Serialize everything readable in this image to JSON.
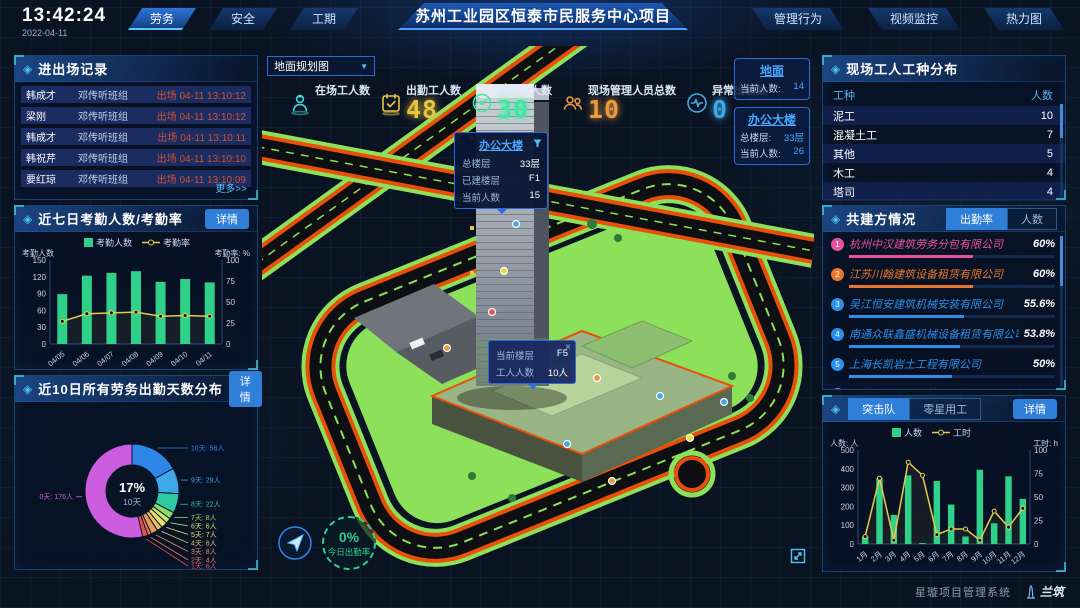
{
  "header": {
    "time": "13:42:24",
    "date": "2022-04-11",
    "nav_left": [
      {
        "label": "劳务",
        "active": true
      },
      {
        "label": "安全",
        "active": false
      },
      {
        "label": "工期",
        "active": false
      }
    ],
    "title": "苏州工业园区恒泰市民服务中心项目",
    "nav_right": [
      {
        "label": "管理行为"
      },
      {
        "label": "视频监控"
      },
      {
        "label": "热力图"
      }
    ]
  },
  "entry_exit": {
    "title": "进出场记录",
    "more_label": "更多>>",
    "rows": [
      {
        "name": "韩成才",
        "team": "邓传听班组",
        "event": "出场 04-11 13:10:12"
      },
      {
        "name": "梁刚",
        "team": "邓传听班组",
        "event": "出场 04-11 13:10:12"
      },
      {
        "name": "韩成才",
        "team": "邓传听班组",
        "event": "出场 04-11 13:10:11"
      },
      {
        "name": "韩祝芹",
        "team": "邓传听班组",
        "event": "出场 04-11 13:10:10"
      },
      {
        "name": "要红琼",
        "team": "邓传听班组",
        "event": "出场 04-11 13:10:09"
      }
    ]
  },
  "attendance_panel": {
    "title": "近七日考勤人数/考勤率",
    "detail_label": "详情",
    "chart": {
      "type": "bar+line",
      "legend": [
        "考勤人数",
        "考勤率"
      ],
      "y_left_label": "考勤人数",
      "y_right_label": "考勤率: %",
      "categories": [
        "04/05",
        "04/06",
        "04/07",
        "04/08",
        "04/09",
        "04/10",
        "04/11"
      ],
      "bars": [
        89,
        122,
        127,
        130,
        111,
        116,
        110
      ],
      "line": [
        27,
        36,
        37,
        38,
        33,
        34,
        33
      ],
      "y_left_max": 150,
      "y_left_ticks": [
        0,
        30,
        60,
        90,
        120,
        150
      ],
      "y_right_max": 100,
      "y_right_ticks": [
        0,
        25,
        50,
        75,
        100
      ],
      "bar_color": "#2fd08a",
      "line_color": "#e8c94f"
    }
  },
  "distribution_panel": {
    "title": "近10日所有劳务出勤天数分布",
    "detail_label": "详情",
    "chart": {
      "type": "donut",
      "center_percent": "17%",
      "center_label": "10天",
      "slices": [
        {
          "label": "10天: 56人",
          "value": 56,
          "color": "#2e86e8"
        },
        {
          "label": "9天: 29人",
          "value": 29,
          "color": "#3fa8e8"
        },
        {
          "label": "8天: 22人",
          "value": 22,
          "color": "#2ec9a0"
        },
        {
          "label": "7天: 8人",
          "value": 8,
          "color": "#8fd86a"
        },
        {
          "label": "6天: 6人",
          "value": 6,
          "color": "#c8e86a"
        },
        {
          "label": "5天: 7人",
          "value": 7,
          "color": "#e8e06a"
        },
        {
          "label": "4天: 6人",
          "value": 6,
          "color": "#e8c06a"
        },
        {
          "label": "3天: 8人",
          "value": 8,
          "color": "#e8985a"
        },
        {
          "label": "2天: 4人",
          "value": 4,
          "color": "#e87a5a"
        },
        {
          "label": "1天: 6人",
          "value": 6,
          "color": "#e85050"
        },
        {
          "label": "0天: 176人",
          "value": 176,
          "color": "#cc5ce0"
        }
      ]
    }
  },
  "scene": {
    "view_selector": {
      "value": "地面规划图"
    },
    "stats": [
      {
        "icon": "worker-icon",
        "label": "在场工人数",
        "value": "",
        "color": "#3fd8d8"
      },
      {
        "icon": "calendar-icon",
        "label": "出勤工人数",
        "value": "48",
        "color": "#e8c53f"
      },
      {
        "icon": "gauge-icon",
        "label": "现场工人数",
        "value": "30",
        "color": "#3fe8a0"
      },
      {
        "icon": "people-icon",
        "label": "现场管理人员总数",
        "value": "10",
        "color": "#e89a3f"
      },
      {
        "icon": "pulse-icon",
        "label": "异常出勤数",
        "value": "0",
        "color": "#3fa8e8"
      }
    ],
    "badges": [
      {
        "title": "地面",
        "rows": [
          {
            "label": "当前人数:",
            "value": "14"
          }
        ]
      },
      {
        "title": "办公大楼",
        "rows": [
          {
            "label": "总楼层:",
            "value": "33层"
          },
          {
            "label": "当前人数:",
            "value": "26"
          }
        ]
      }
    ],
    "tower_tooltip": {
      "title": "办公大楼",
      "rows": [
        {
          "label": "总楼层",
          "value": "33层"
        },
        {
          "label": "已建楼层",
          "value": "F1"
        },
        {
          "label": "当前人数",
          "value": "15"
        }
      ]
    },
    "floor_tooltip": {
      "close_label": "×",
      "rows": [
        {
          "label": "当前楼层",
          "value": "F5"
        },
        {
          "label": "工人人数",
          "value": "10人"
        }
      ]
    },
    "attendance_badge": {
      "percent": "0%",
      "label": "今日出勤率"
    }
  },
  "worker_types": {
    "title": "现场工人工种分布",
    "headers": [
      "工种",
      "人数"
    ],
    "rows": [
      {
        "type": "泥工",
        "count": "10"
      },
      {
        "type": "混凝土工",
        "count": "7"
      },
      {
        "type": "其他",
        "count": "5"
      },
      {
        "type": "木工",
        "count": "4"
      },
      {
        "type": "塔司",
        "count": "4"
      }
    ]
  },
  "partners": {
    "title": "共建方情况",
    "tabs": [
      {
        "label": "出勤率",
        "active": true
      },
      {
        "label": "人数",
        "active": false
      }
    ],
    "items": [
      {
        "rank": "1",
        "name": "杭州中汉建筑劳务分包有限公司",
        "value": "60%",
        "pct": 60,
        "color": "#e8529a"
      },
      {
        "rank": "2",
        "name": "江苏川翰建筑设备租赁有限公司",
        "value": "60%",
        "pct": 60,
        "color": "#e8762e"
      },
      {
        "rank": "3",
        "name": "吴江恒安建筑机械安装有限公司",
        "value": "55.6%",
        "pct": 55.6,
        "color": "#2e8fe8"
      },
      {
        "rank": "4",
        "name": "南通众联鑫盛机械设备租赁有限公司",
        "value": "53.8%",
        "pct": 53.8,
        "color": "#2e8fe8"
      },
      {
        "rank": "5",
        "name": "上海长凯岩土工程有限公司",
        "value": "50%",
        "pct": 50,
        "color": "#2e8fe8"
      },
      {
        "rank": "6",
        "name": "江苏浩诒建筑安装工程有限公司",
        "value": "35.4%",
        "pct": 35.4,
        "color": "#9a6ae8"
      }
    ]
  },
  "squad_panel": {
    "tabs": [
      {
        "label": "突击队",
        "active": true
      },
      {
        "label": "零星用工",
        "active": false
      }
    ],
    "detail_label": "详情",
    "chart": {
      "type": "bar+line",
      "legend": [
        "人数",
        "工时"
      ],
      "y_left_label": "人数: 人",
      "y_right_label": "工时: h",
      "categories": [
        "1月",
        "2月",
        "3月",
        "4月",
        "5月",
        "6月",
        "7月",
        "8月",
        "9月",
        "10月",
        "11月",
        "12月"
      ],
      "bars": [
        40,
        350,
        155,
        365,
        5,
        335,
        210,
        40,
        395,
        110,
        360,
        240
      ],
      "line": [
        8,
        70,
        4,
        87,
        73,
        10,
        16,
        16,
        4,
        35,
        18,
        38
      ],
      "y_left_max": 500,
      "y_left_ticks": [
        0,
        100,
        200,
        300,
        400,
        500
      ],
      "y_right_max": 100,
      "y_right_ticks": [
        0,
        25,
        50,
        75,
        100
      ],
      "bar_color": "#2fd08a",
      "line_color": "#e8c94f"
    }
  },
  "footer": {
    "system_name": "星璇项目管理系统",
    "logo_text": "兰筑"
  }
}
